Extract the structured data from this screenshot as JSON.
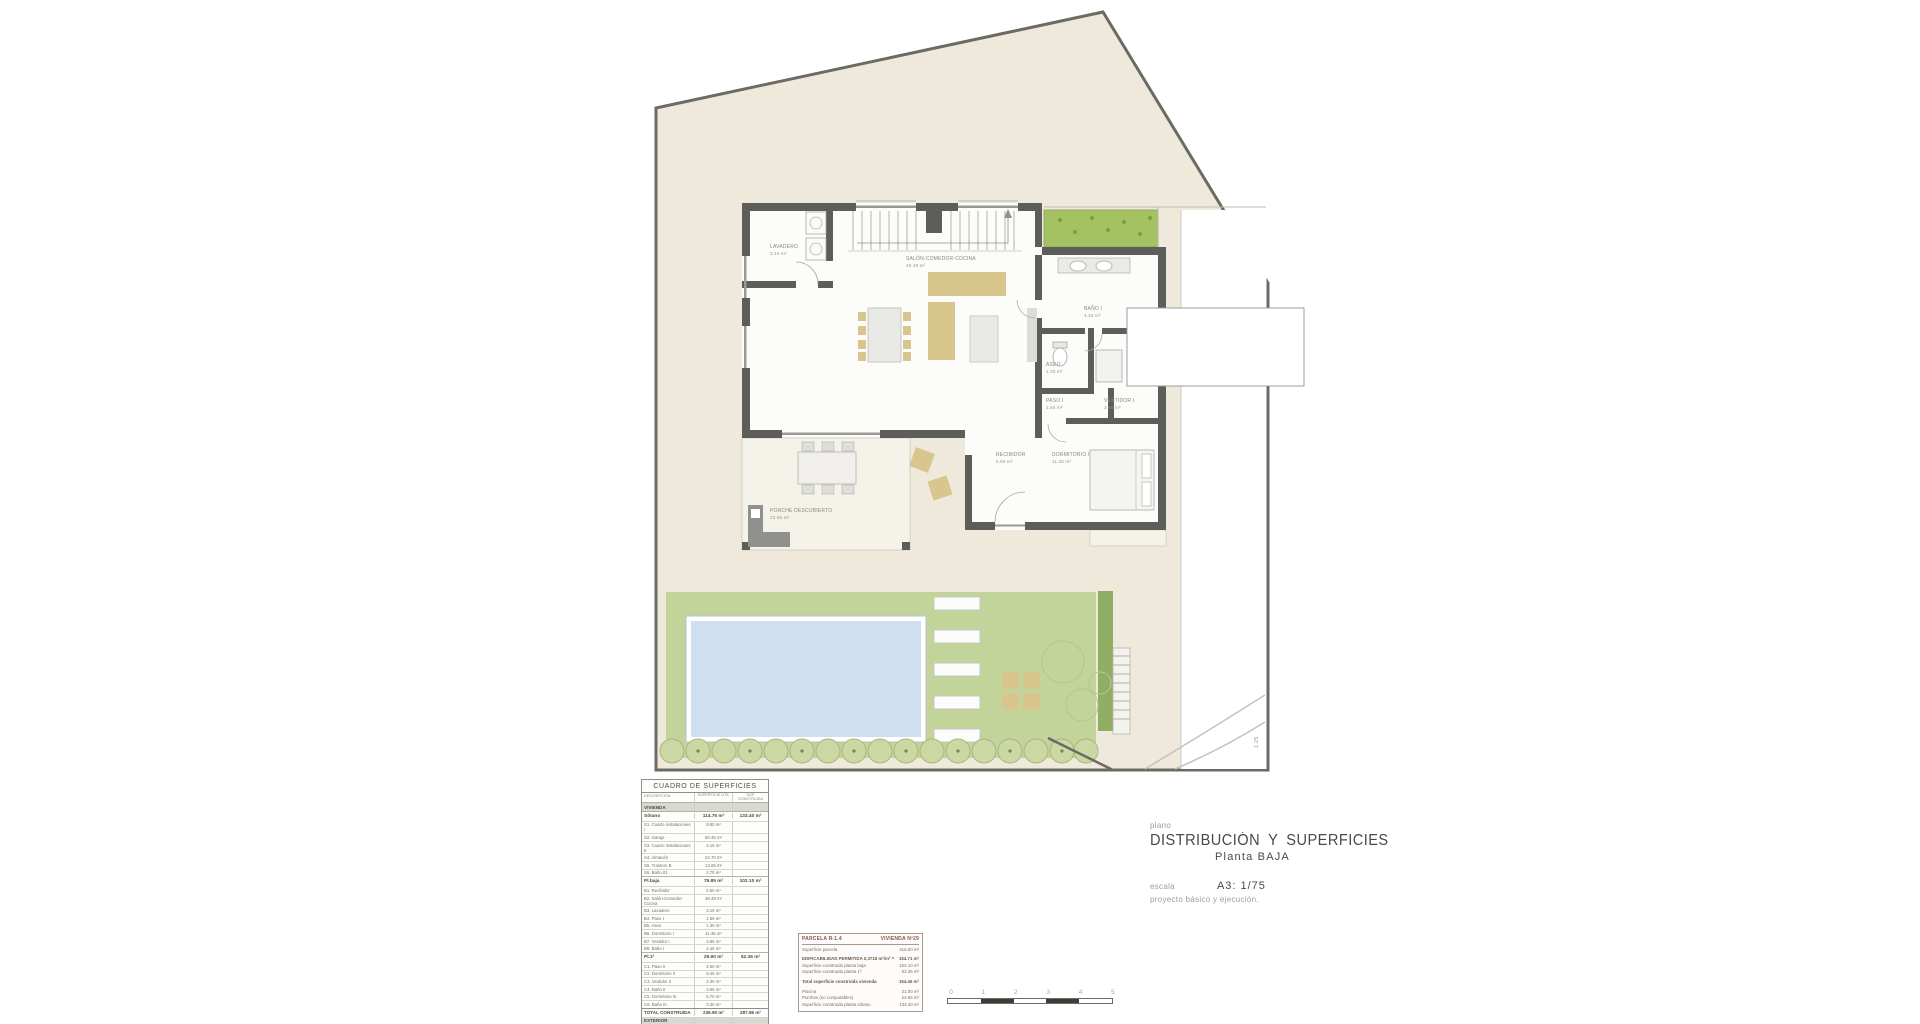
{
  "colors": {
    "parcel_fill": "#efe9dc",
    "parcel_border": "#6b6b64",
    "wall": "#5d5d59",
    "lawn": "#c3d49b",
    "pool_water": "#cfdff1",
    "planter_green": "#a5c263",
    "furniture_tan": "#d9c58e",
    "band_gray": "#d9d9d2"
  },
  "plan": {
    "room_labels": [
      {
        "name": "LAVADERO",
        "area": "3.15 m²"
      },
      {
        "name": "SALÓN-COMEDOR-COCINA",
        "area": "48.49 m²"
      },
      {
        "name": "BAÑO I",
        "area": "4.45 m²"
      },
      {
        "name": "ASEO",
        "area": "1.30 m²"
      },
      {
        "name": "PASO I",
        "area": "1.66 m²"
      },
      {
        "name": "VESTIDOR I",
        "area": "3.85 m²"
      },
      {
        "name": "DORMITORIO I",
        "area": "11.35 m²"
      },
      {
        "name": "RECIBIDOR",
        "area": "5.60 m²"
      },
      {
        "name": "PORCHE DESCUBIERTO",
        "area": "23.55 m²"
      }
    ],
    "side_annotation": "1.25"
  },
  "surfaces_table": {
    "title": "CUADRO DE SUPERFICIES",
    "columns": [
      "DESCRIPCIÓN",
      "SUPERFICIE ÚTIL",
      "SUP. CONSTRUIDA"
    ],
    "rows": [
      {
        "type": "band",
        "label": "VIVIENDA"
      },
      {
        "type": "group",
        "label": "Sótano",
        "util": "114.75 m²",
        "cons": "133.40 m²"
      },
      {
        "type": "item",
        "label": "S1. Cuarto instalaciones I",
        "util": "9.80 m²"
      },
      {
        "type": "item",
        "label": "S2. Garaje",
        "util": "60.35 m²"
      },
      {
        "type": "item",
        "label": "S3. Cuarto instalaciones II",
        "util": "4.15 m²"
      },
      {
        "type": "item",
        "label": "S4. Almacén",
        "util": "24.70 m²"
      },
      {
        "type": "item",
        "label": "S5. Trastero B",
        "util": "13.05 m²"
      },
      {
        "type": "item",
        "label": "S6. Baño 01",
        "util": "2.70 m²"
      },
      {
        "type": "group",
        "label": "Pl.baja",
        "util": "79.85 m²",
        "cons": "102.10 m²"
      },
      {
        "type": "item",
        "label": "B1. Recibidor",
        "util": "5.60 m²"
      },
      {
        "type": "item",
        "label": "B2. Salón-Comedor-Cocina",
        "util": "48.49 m²"
      },
      {
        "type": "item",
        "label": "B3. Lavadero",
        "util": "3.15 m²"
      },
      {
        "type": "item",
        "label": "B4. Paso I",
        "util": "1.66 m²"
      },
      {
        "type": "item",
        "label": "B5. Aseo",
        "util": "1.30 m²"
      },
      {
        "type": "item",
        "label": "B6. Dormitorio I",
        "util": "11.35 m²"
      },
      {
        "type": "item",
        "label": "B7. Vestidor I",
        "util": "3.85 m²"
      },
      {
        "type": "item",
        "label": "B8. Baño I",
        "util": "4.45 m²"
      },
      {
        "type": "group",
        "label": "Pl.1ª",
        "util": "29.90 m²",
        "cons": "52.36 m²"
      },
      {
        "type": "item",
        "label": "C1. Paso II",
        "util": "4.50 m²"
      },
      {
        "type": "item",
        "label": "C2. Dormitorio II",
        "util": "9.45 m²"
      },
      {
        "type": "item",
        "label": "C3. Vestidor II",
        "util": "2.30 m²"
      },
      {
        "type": "item",
        "label": "C4. Baño II",
        "util": "3.65 m²"
      },
      {
        "type": "item",
        "label": "C5. Dormitorio III",
        "util": "6.70 m²"
      },
      {
        "type": "item",
        "label": "C6. Baño III",
        "util": "3.30 m²"
      },
      {
        "type": "total",
        "label": "TOTAL CONSTRUIDA",
        "util": "236.90 m²",
        "cons": "287.86 m²"
      },
      {
        "type": "band",
        "label": "EXTERIOR"
      },
      {
        "type": "item",
        "label": "E01. Piscina",
        "util": "21.00 m²"
      },
      {
        "type": "item",
        "label": "E02. Terraza descubierta",
        "label2": "(no computable)",
        "util": "23.55 m²"
      },
      {
        "type": "item",
        "label": "E03. Jardín descubierto",
        "label2": "(no computable)",
        "util": "188.85 m²"
      }
    ]
  },
  "parcel_box": {
    "header_left": "PARCELA R-1.4",
    "header_right": "VIVIENDA Nº29",
    "rows": [
      {
        "label": "Superficie parcela",
        "value": "416.00 m²"
      },
      {
        "label": "EDIFICABILIDAD PERMITIDA  0,3718 m²/m² =",
        "value": "154.71 m²",
        "style": "b",
        "gap": "g"
      },
      {
        "label": "Superficie construida planta baja",
        "value": "102.10 m²"
      },
      {
        "label": "Superficie construida planta 1ª",
        "value": "52.36 m²"
      },
      {
        "label": "Total superficie construida vivienda",
        "value": "154.46 m²",
        "style": "b",
        "gap": "g"
      },
      {
        "label": "Piscina",
        "value": "21.00 m²",
        "gap": "g"
      },
      {
        "label": "Porches (no computables)",
        "value": "23.55 m²"
      },
      {
        "label": "Superficie construida planta sótano",
        "value": "133.40 m²"
      }
    ]
  },
  "title_block": {
    "plano_label": "plano",
    "title": "DISTRIBUCIÓN Y SUPERFICIES",
    "subtitle": "Planta BAJA",
    "escala_label": "escala",
    "escala_value": "A3: 1/75",
    "project_note": "proyecto básico y ejecución."
  },
  "scale_bar": {
    "ticks": [
      "0",
      "1",
      "2",
      "3",
      "4",
      "5"
    ]
  }
}
